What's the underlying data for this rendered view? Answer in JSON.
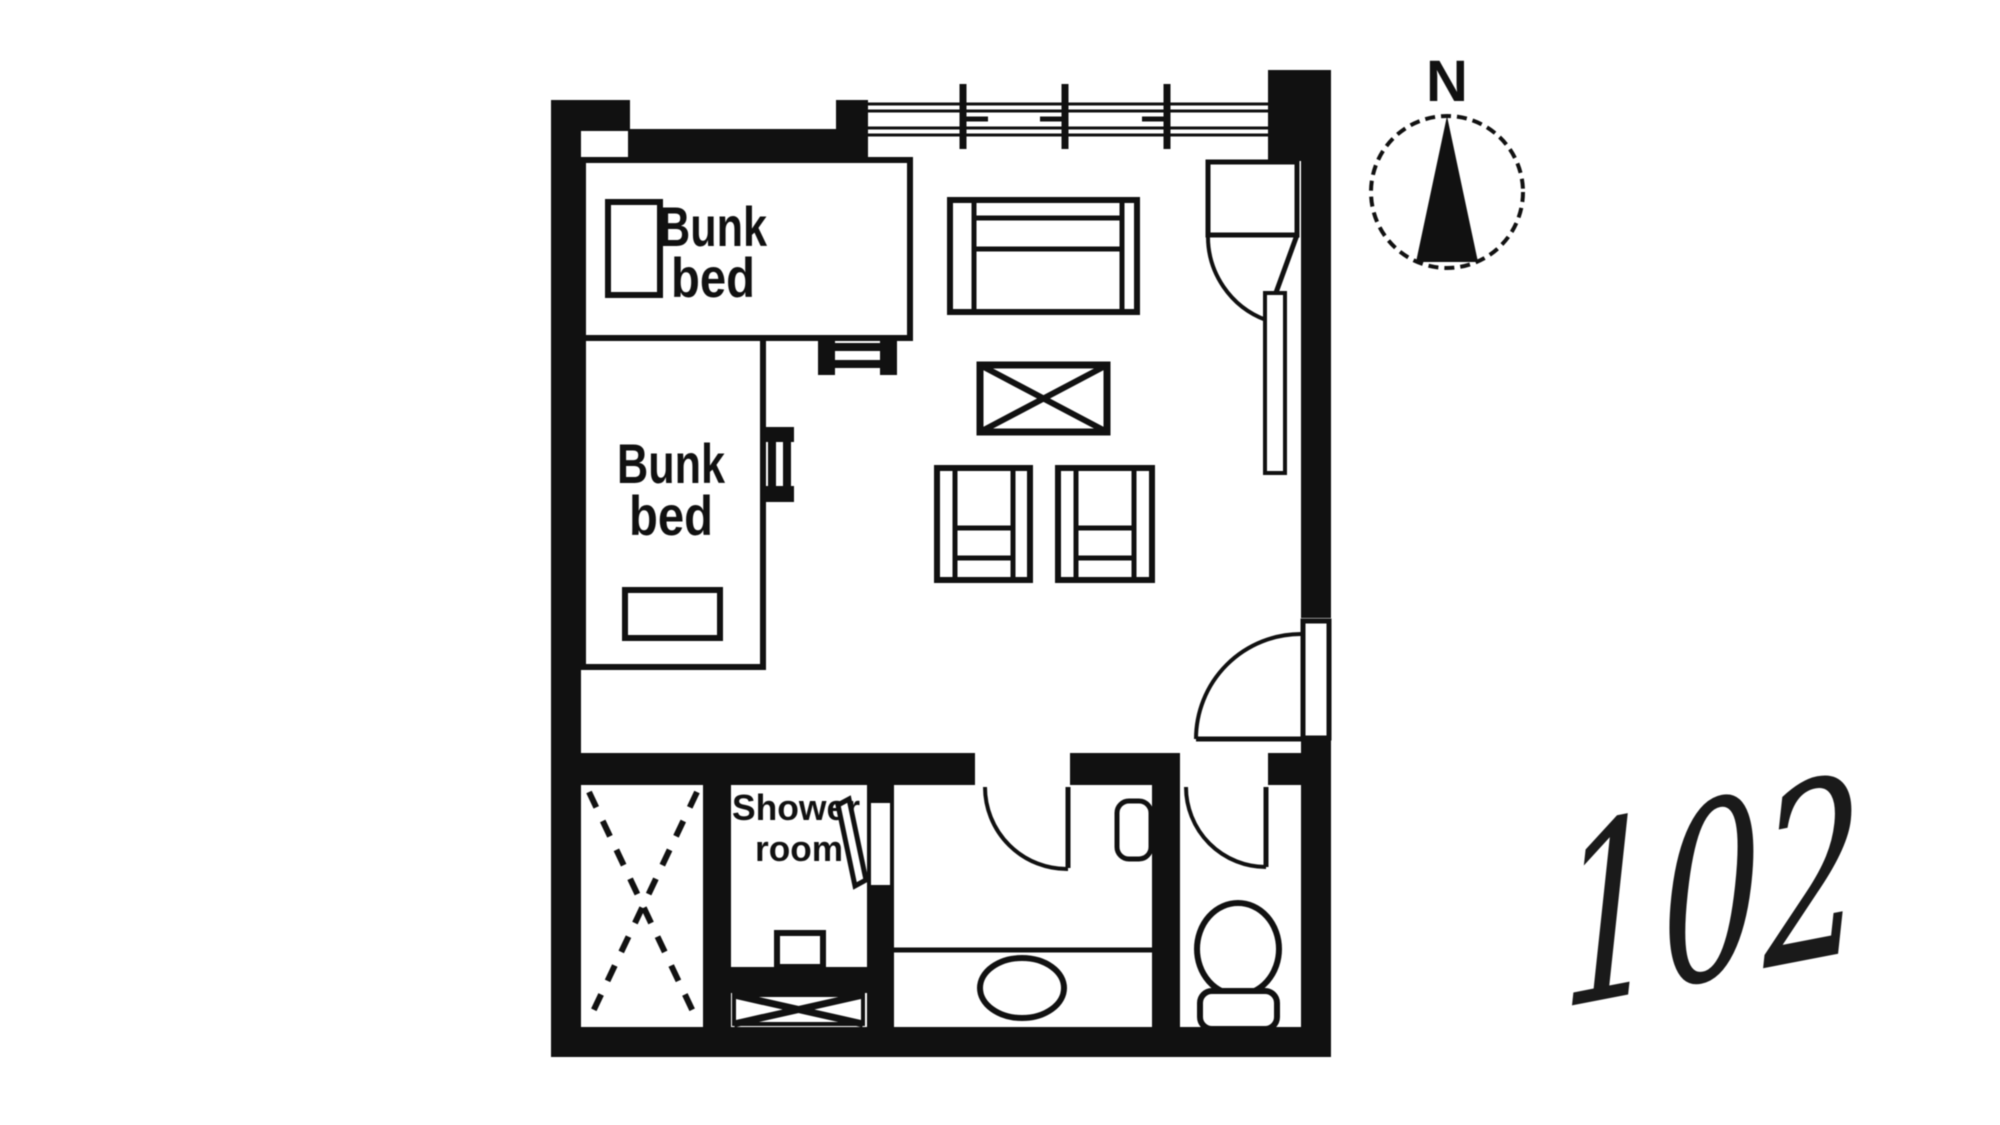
{
  "colors": {
    "background": "#ffffff",
    "ink": "#111111"
  },
  "floor_plan": {
    "room_number": "102",
    "compass_label": "N",
    "labels": {
      "bunk_bed_upper": {
        "line1": "Bunk",
        "line2": "bed"
      },
      "bunk_bed_lower": {
        "line1": "Bunk",
        "line2": "bed"
      },
      "shower_room": {
        "line1": "Shower",
        "line2": "room"
      }
    },
    "symbols": [
      "compass-icon",
      "window-icon",
      "entrance-door-swing-icon",
      "wardrobe-door-swing-icon",
      "bunk-bed-icon",
      "bunk-bed-icon",
      "pillow-icon",
      "pillow-icon",
      "ladder-icon",
      "ladder-icon",
      "sofa-icon",
      "coffee-table-cross-icon",
      "chair-icon",
      "chair-icon",
      "closet-dashed-cross-icon",
      "shower-door-icon",
      "shower-unit-icon",
      "vent-cross-icon",
      "washbasin-counter-icon",
      "wall-cabinet-icon",
      "toilet-icon",
      "door-swing-icon",
      "door-swing-icon"
    ]
  }
}
